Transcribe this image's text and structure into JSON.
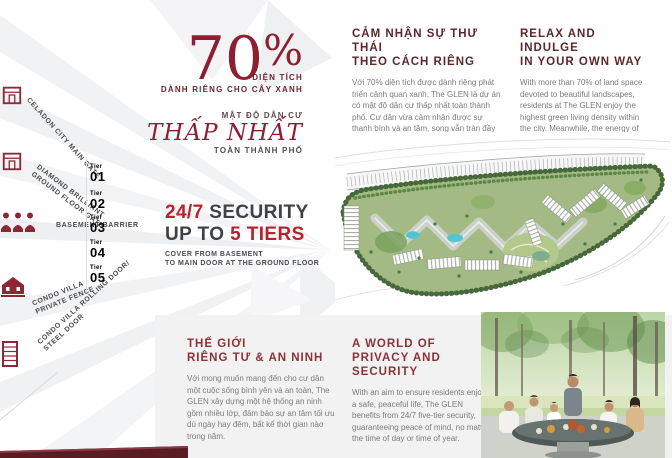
{
  "colors": {
    "brand_red": "#8e1f30",
    "accent_red": "#b5232e",
    "dark_maroon": "#5d272c",
    "panel_gray": "#f2f2f3",
    "bar_maroon": "#5a1c23"
  },
  "left_panel": {
    "items": [
      {
        "icon": "main-gate-icon",
        "line1": "CELADON CITY MAIN GATE",
        "line2": ""
      },
      {
        "icon": "ground-floor-gate-icon",
        "line1": "DIAMOND BRILLIANT",
        "line2": "GROUND FLOOR GATE"
      },
      {
        "icon": "security-guards-icon",
        "line1": "BASEMENT BARRIER",
        "line2": ""
      },
      {
        "icon": "villa-fence-icon",
        "line1": "CONDO VILLA",
        "line2": "PRIVATE FENCE"
      },
      {
        "icon": "steel-door-icon",
        "line1": "CONDO VILLA ROLLING DOOR/",
        "line2": "STEEL DOOR"
      }
    ],
    "tiers": [
      {
        "word": "Tier",
        "num": "01"
      },
      {
        "word": "Tier",
        "num": "02"
      },
      {
        "word": "Tier",
        "num": "03"
      },
      {
        "word": "Tier",
        "num": "04"
      },
      {
        "word": "Tier",
        "num": "05"
      }
    ]
  },
  "stats": {
    "percent_value": "70",
    "percent_sign": "%",
    "percent_caption": "DIỆN TÍCH",
    "percent_caption2": "DÀNH RIÊNG CHO CÂY XANH",
    "density_caption": "MẬT ĐỘ DÂN CƯ",
    "density_main": "THẤP NHẤT",
    "density_sub": "TOÀN THÀNH PHỐ",
    "security_red1": "24/7",
    "security_dark1": " SECURITY",
    "security_dark2": "UP TO ",
    "security_red2": "5 TIERS",
    "security_sub1": "COVER FROM BASEMENT",
    "security_sub2": "TO MAIN DOOR AT THE GROUND FLOOR"
  },
  "sections": {
    "relax_vi": {
      "title1": "CẢM NHẬN SỰ THƯ THÁI",
      "title2": "THEO CÁCH RIÊNG",
      "body": "Với 70% diện tích được dành riêng phát triển cảnh quan xanh, The GLEN là dự án có mật độ dân cư thấp nhất toàn thành phố. Cư dân vừa cảm nhận được sự thanh bình và an tâm, song vẫn tràn đầy năng lượng với những trải nghiệm đáng giá nhờ quy hoạch thông minh, thiết kế sáng tạo, không gian sang trọng và hệ thống tiện ích tuyệt vời."
    },
    "relax_en": {
      "title1": "RELAX AND INDULGE",
      "title2": "IN YOUR OWN WAY",
      "body": "With more than 70% of land space devoted to beautiful landscapes, residents at The GLEN enjoy the highest green living density within the city. Meanwhile, the energy of the adjacent entertainment and shopping centre make this a perfect blend of peaceful and secure yet buzzing lifestyles with amenities that satisfy every taste and preference."
    },
    "privacy_vi": {
      "title1": "THẾ GIỚI",
      "title2": "RIÊNG TƯ & AN NINH",
      "body": "Với mong muốn mang đến cho cư dân một cuộc sống bình yên và an toàn, The GLEN xây dựng một hệ thống an ninh gồm nhiều lớp, đảm bảo sự an tâm tối ưu dù ngày hay đêm, bất kể thời gian nào trong năm."
    },
    "privacy_en": {
      "title1": "A WORLD OF",
      "title2": "PRIVACY AND SECURITY",
      "body": "With an aim to ensure residents enjoy a safe, peaceful life, The GLEN benefits from 24/7 five-tier security, guaranteeing peace of mind, no matter the time of day or time of year."
    }
  },
  "media": {
    "masterplan_alt": "site-master-plan",
    "photo_alt": "family-dining-photo"
  }
}
